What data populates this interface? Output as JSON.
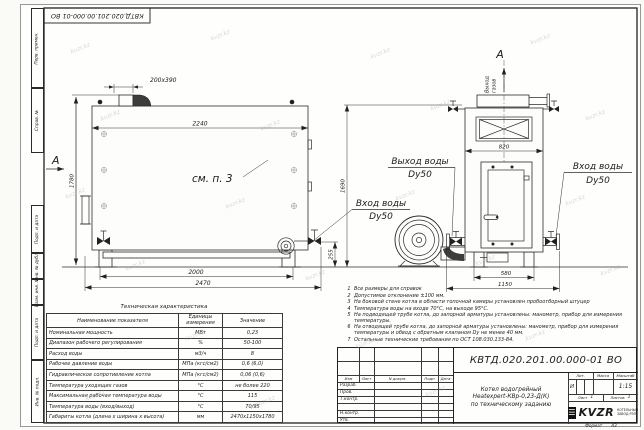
{
  "watermark": {
    "text": "kvzr.kz"
  },
  "sheet": {
    "stamp_designation": "КВТД.020.201.00.000-01 ВО",
    "format_label": "Формат",
    "format_value": "А3",
    "margin_labels": [
      "Перв. примен.",
      "Справ. №",
      "Подп. и дата",
      "Инв. № дубл.",
      "Взам. инв. №",
      "Подп. и дата",
      "Инв. № подл."
    ]
  },
  "drawing": {
    "section_a_left": "А",
    "section_a_right": "А",
    "see_item": "см. п. 3",
    "gas_outlet_line1": "Выход",
    "gas_outlet_line2": "газов",
    "labels": {
      "water_out": "Выход воды",
      "water_out_dn": "Dy50",
      "water_in_mid": "Вход воды",
      "water_in_mid_dn": "Dy50",
      "water_in_right": "Вход воды",
      "water_in_right_dn": "Dy50"
    },
    "dims": {
      "duct": "200x390",
      "front_width": "2240",
      "front_height": "1780",
      "front_leg_span": "2000",
      "front_total": "2470",
      "pipe_height": "255",
      "side_height": "1690",
      "side_width": "820",
      "side_leg_span": "580",
      "side_total": "1150"
    }
  },
  "tech_table": {
    "title": "Техническая характеристика",
    "col_name": "Наименование показателя",
    "col_units_1": "Единицы",
    "col_units_2": "измерения",
    "col_value": "Значение",
    "rows": [
      [
        "Номинальная мощность",
        "МВт",
        "0,23"
      ],
      [
        "Диапазон рабочего регулирования",
        "%",
        "50-100"
      ],
      [
        "Расход воды",
        "м3/ч",
        "8"
      ],
      [
        "Рабочее давление воды",
        "МПа (кгс/см2)",
        "0,6 (6,0)"
      ],
      [
        "Гидравлическое сопротивление котла",
        "МПа (кгс/см2)",
        "0,06 (0,6)"
      ],
      [
        "Температура уходящих газов",
        "°С",
        "не более 220"
      ],
      [
        "Максимальная рабочая температура воды",
        "°С",
        "115"
      ],
      [
        "Температура воды (вход/выход)",
        "°С",
        "70/95"
      ],
      [
        "Габариты котла (длина х ширина х высота)",
        "мм",
        "2470х1150х1780"
      ]
    ]
  },
  "notes": {
    "items": [
      {
        "no": "1",
        "text": "Все размеры для справок"
      },
      {
        "no": "2",
        "text": "Допустимое отклонение ±100 мм."
      },
      {
        "no": "3",
        "text": "На боковой стене котла в области топочной камеры установлен пробоотборный штуцер"
      },
      {
        "no": "4",
        "text": "Температура воды на входе 70°С, на выходе 95°С."
      },
      {
        "no": "5",
        "text": "На подводящей трубе котла, до запорной арматуры установлены: манометр, прибор для измерения температуры."
      },
      {
        "no": "6",
        "text": "На отводящей трубе котла, до запорной арматуры установлены: манометр, прибор для измерения температуры и обвод с обратным клапаном Dу не менее 40 мм."
      },
      {
        "no": "7",
        "text": "Остальные технические требования по ОСТ 108.030.133-84."
      }
    ]
  },
  "title_block": {
    "designation": "КВТД.020.201.00.000-01 ВО",
    "product_line1": "Котел водогрейный",
    "product_line2": "Heatexpert-КВр-0,23-Д(К)",
    "product_line3": "по техническому заданию",
    "rev_headers": [
      "Изм",
      "Лист",
      "N докум.",
      "Подп",
      "Дата"
    ],
    "rev_rows": [
      "Разраб.",
      "Пров.",
      "Т.контр.",
      "",
      "Н.контр.",
      "Утв."
    ],
    "lit_label": "Лит.",
    "mass_label": "Масса",
    "scale_label": "Масштаб",
    "lit_value": "И",
    "scale_value": "1:15",
    "sheet_label": "Лист",
    "sheet_value": "1",
    "sheets_label": "Листов",
    "sheets_value": "1",
    "logo_text": "KVZR",
    "logo_caption1": "КОТЕЛЬНЫЙ",
    "logo_caption2": "ЗАВОД РЭП"
  }
}
